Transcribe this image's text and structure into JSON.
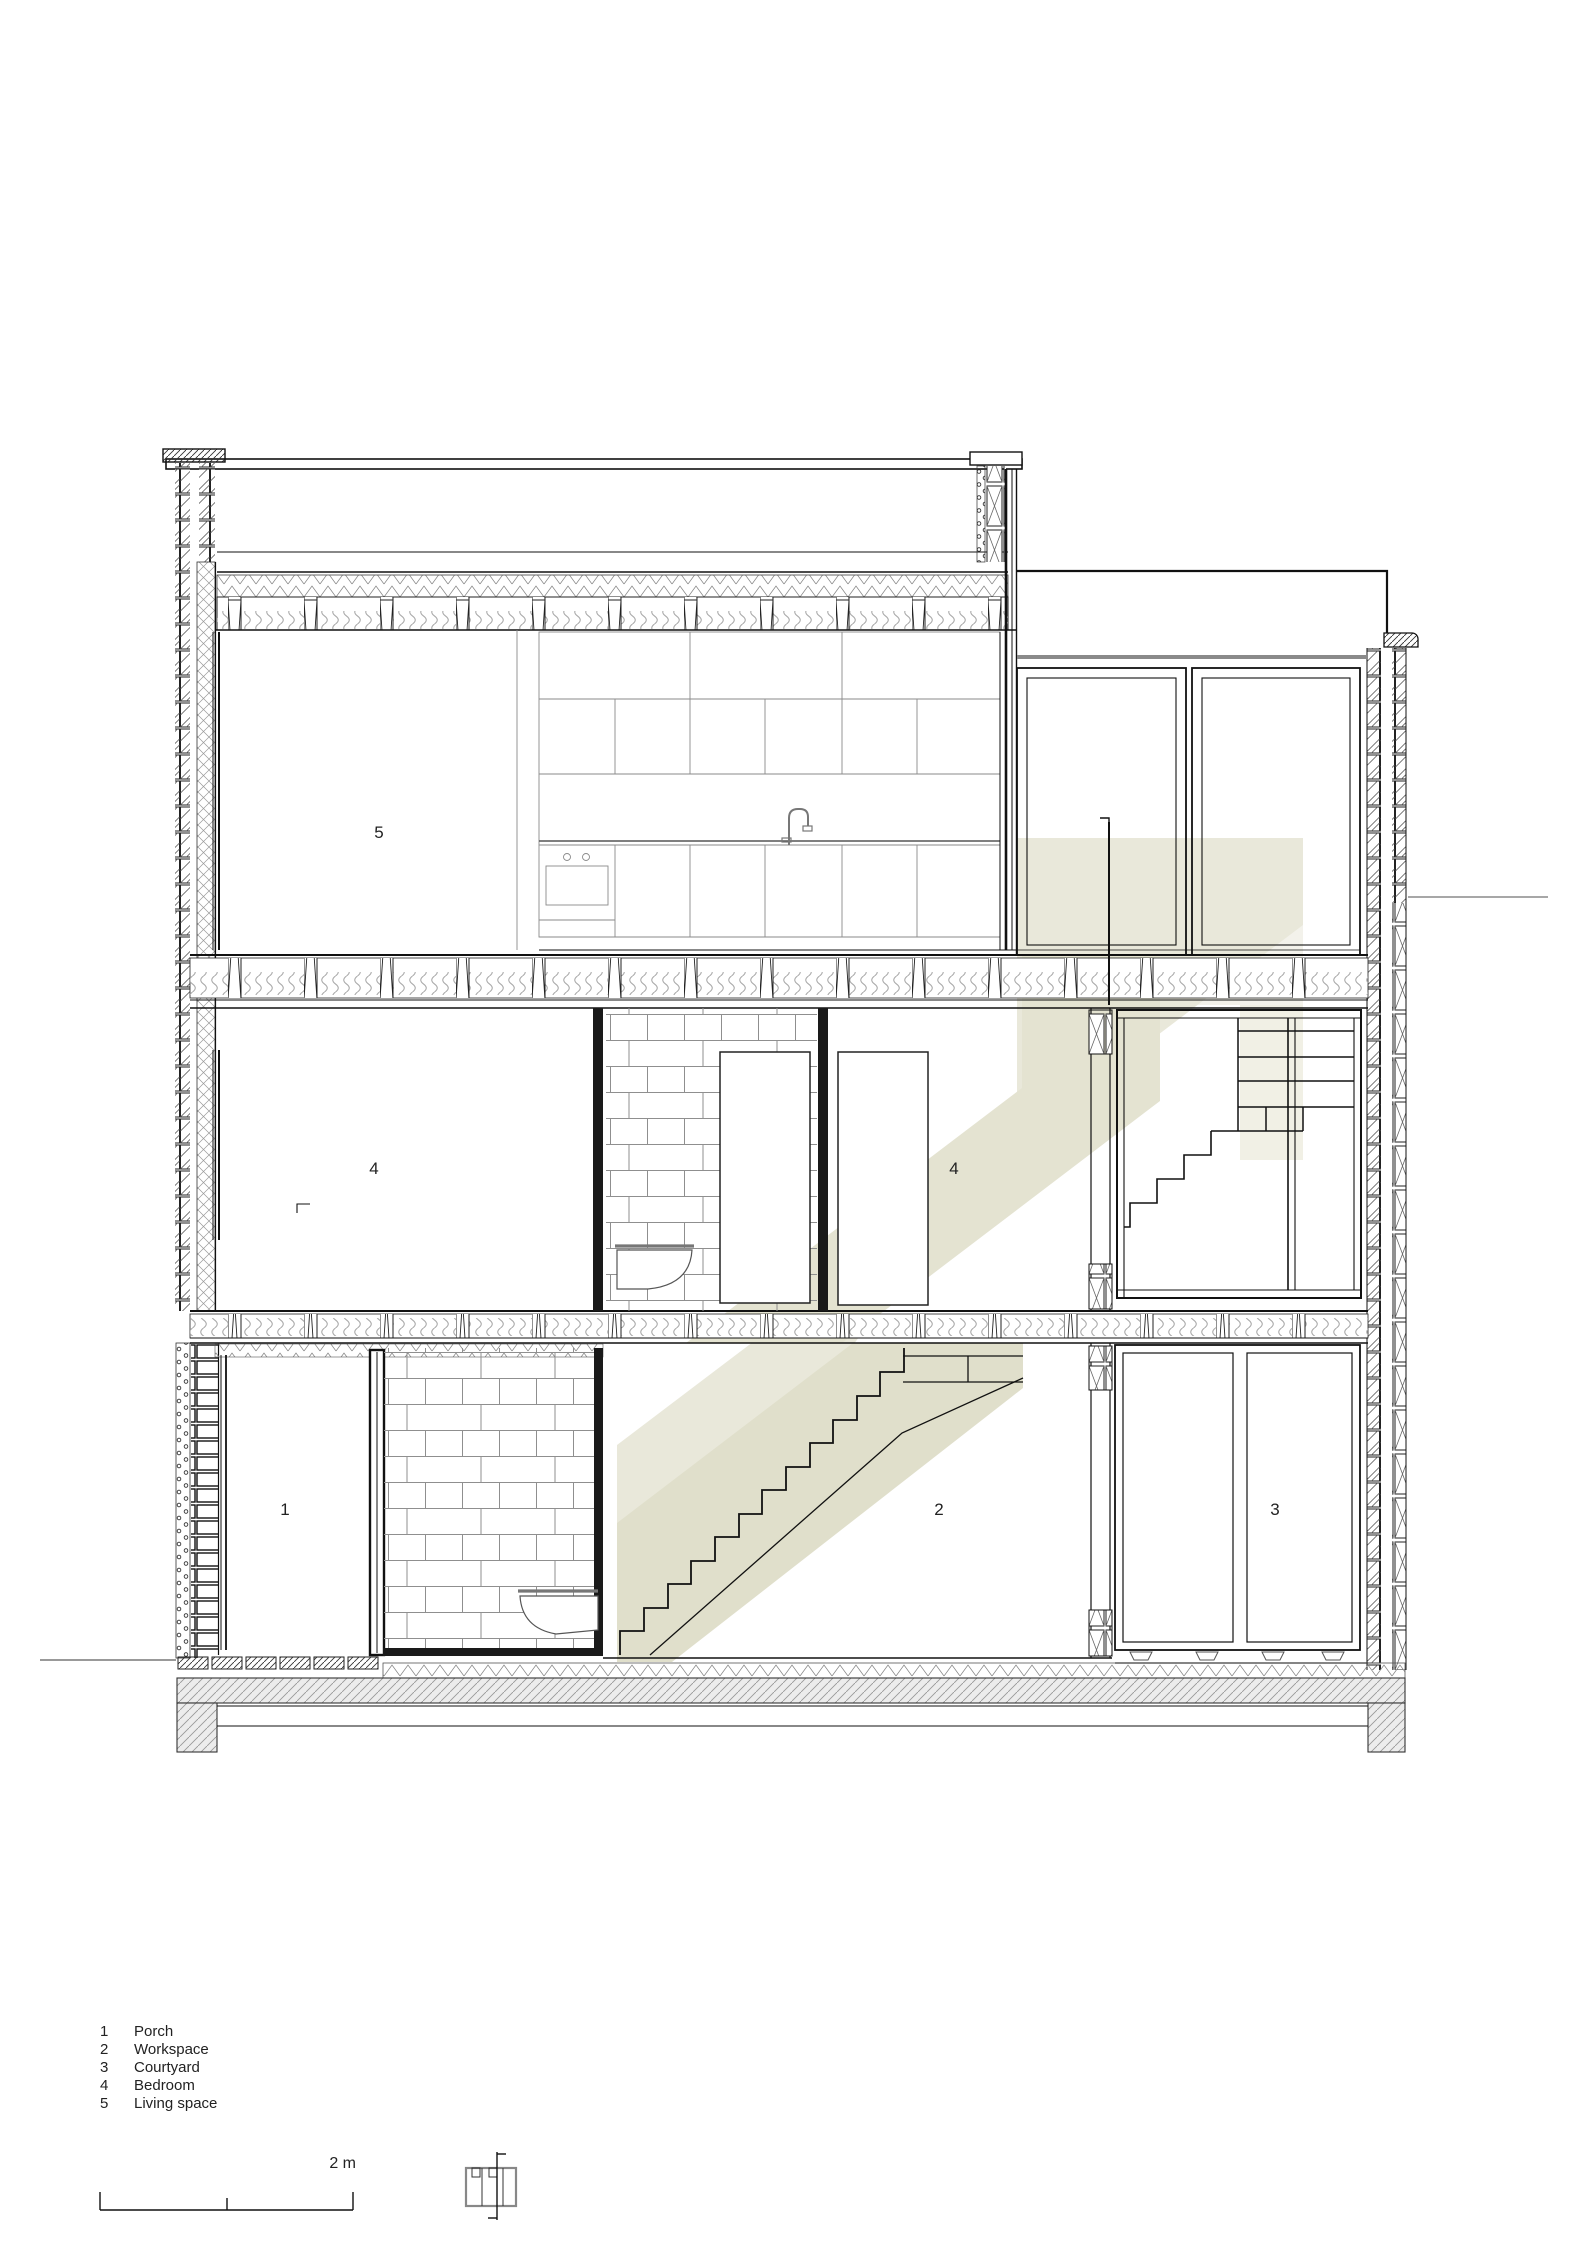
{
  "drawing": {
    "kind": "architectural cross section",
    "rooms": {
      "porch": {
        "number": "1",
        "name": "Porch"
      },
      "workspace": {
        "number": "2",
        "name": "Workspace"
      },
      "courtyard": {
        "number": "3",
        "name": "Courtyard"
      },
      "bedroom": {
        "number": "4",
        "name": "Bedroom"
      },
      "living": {
        "number": "5",
        "name": "Living space"
      }
    }
  },
  "legend": {
    "items": [
      {
        "number": "1",
        "label": "Porch"
      },
      {
        "number": "2",
        "label": "Workspace"
      },
      {
        "number": "3",
        "label": "Courtyard"
      },
      {
        "number": "4",
        "label": "Bedroom"
      },
      {
        "number": "5",
        "label": "Living space"
      }
    ]
  },
  "scale": {
    "label": "2 m"
  },
  "colors": {
    "line": "#1a1a1a",
    "stair_shade_light": "#e9e8da",
    "stair_shade_dark": "#e0dfcb",
    "stair_shade_mid": "#e4e3d1",
    "grey_line": "#8a8a8a"
  }
}
